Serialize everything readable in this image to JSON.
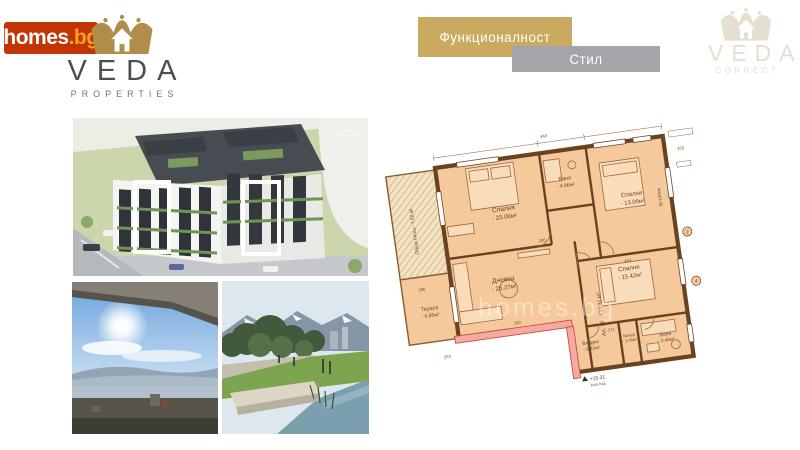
{
  "header": {
    "homes_logo": {
      "main": "homes",
      "suffix": ".bg"
    },
    "veda_properties": {
      "name": "VEDA",
      "subtitle": "PROPERTIES"
    },
    "banner_function": {
      "label": "Функционалност"
    },
    "banner_style": {
      "label": "Стил"
    },
    "veda_correct": {
      "name": "VEDA",
      "subtitle": "CORRECT"
    }
  },
  "gallery": {
    "building_render": {
      "watermark": "VEDA"
    }
  },
  "floor_plan": {
    "watermark": "homes.bg",
    "apartment_label": "Ап. 25 - 134.31 м²",
    "common_area_label": "Обща площ - 7.02 м²",
    "window_height_label": "В=150см",
    "elevation_value": "+15.31",
    "elevation_caption": "кота под",
    "rooms": [
      {
        "name": "Спалня",
        "area": "- 23.06м²"
      },
      {
        "name": "Баня",
        "area": "- 4.96м²"
      },
      {
        "name": "Спалня",
        "area": "- 13.06м²"
      },
      {
        "name": "Дневна",
        "area": "- 25.27м²"
      },
      {
        "name": "Спалня",
        "area": "- 15.42м²"
      },
      {
        "name": "Килер",
        "area": "- 1.05м²"
      },
      {
        "name": "Баня",
        "area": "- 3.49м²"
      },
      {
        "name": "Входно",
        "area": "- 9.42м²"
      },
      {
        "name": "Тераса",
        "area": "- 6.85м²"
      }
    ],
    "dimensions": [
      "286",
      "253",
      "100",
      "163",
      "443",
      "171",
      "449",
      "150"
    ],
    "markers": [
      "2",
      "4"
    ]
  },
  "colors": {
    "homes_red": "#c13505",
    "homes_orange": "#f9a11b",
    "veda_gold": "#b08d4a",
    "banner_gold": "#c9aa60",
    "banner_gray": "#a4a4a9",
    "veda_correct_beige": "#e5dfcf",
    "plan_room_fill": "#f5c99c",
    "plan_wall": "#6b4220",
    "plan_highlight_wall": "#f2aaa2"
  }
}
